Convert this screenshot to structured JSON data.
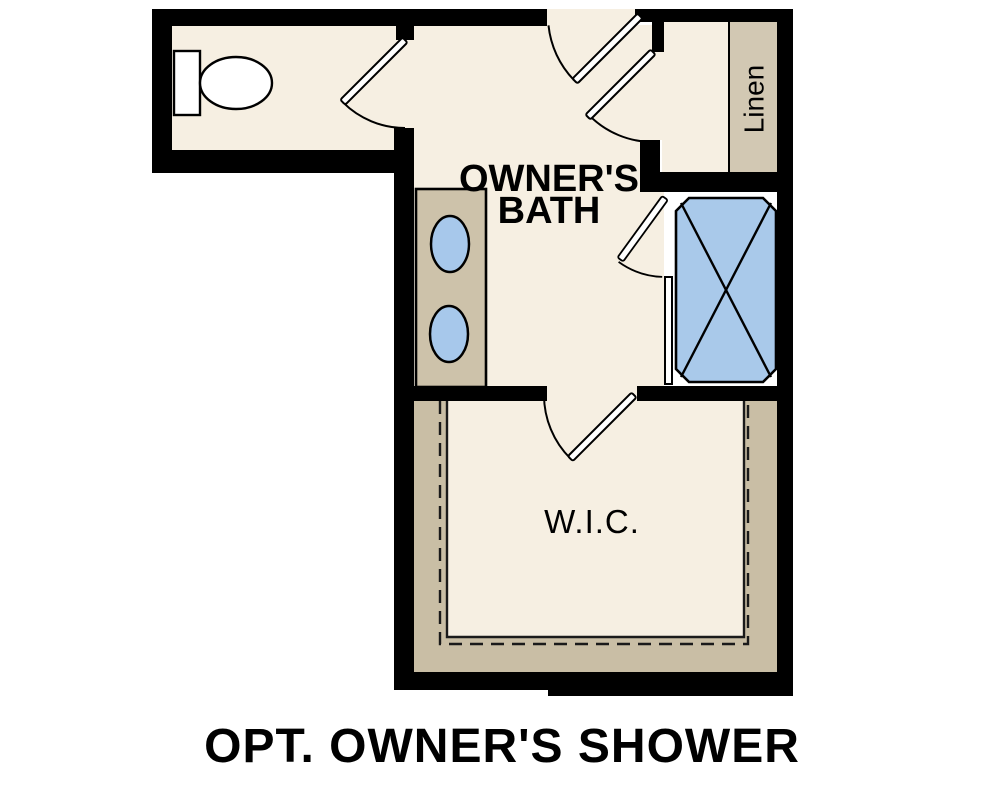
{
  "title": "OPT. OWNER'S SHOWER",
  "rooms": {
    "bath": {
      "label_line1": "OWNER'S",
      "label_line2": "BATH"
    },
    "wic": {
      "label": "W.I.C."
    },
    "linen": {
      "label": "Linen"
    }
  },
  "colors": {
    "wall": "#000000",
    "floor": "#f6efe2",
    "linen_shelf": "#d2c8b3",
    "vanity": "#cdc2aa",
    "wic_shelf": "#c9bea5",
    "shower": "#a9c9ea",
    "sink": "#a7c8eb",
    "fixture": "#ffffff"
  }
}
